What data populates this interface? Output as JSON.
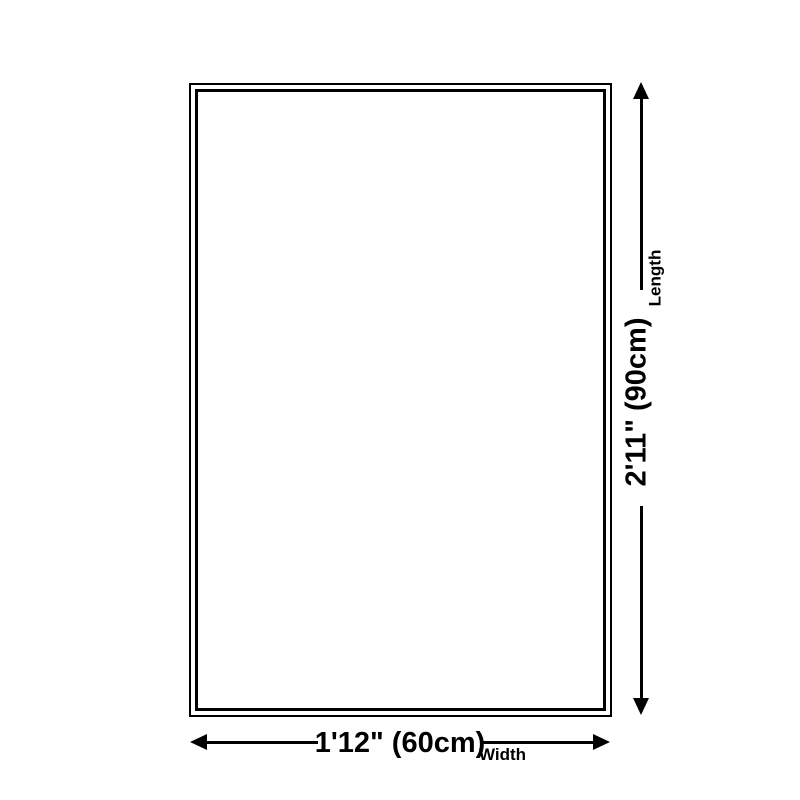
{
  "diagram": {
    "type": "product-dimension-diagram",
    "shape": "rectangle",
    "width": {
      "value": "1'12\" (60cm)",
      "label": "Width"
    },
    "length": {
      "value": "2'11\" (90cm)",
      "label": "Length"
    },
    "colors": {
      "line": "#000000",
      "background": "#ffffff"
    },
    "icons": [
      "arrow-up-icon",
      "arrow-down-icon",
      "arrow-left-icon",
      "arrow-right-icon"
    ]
  }
}
